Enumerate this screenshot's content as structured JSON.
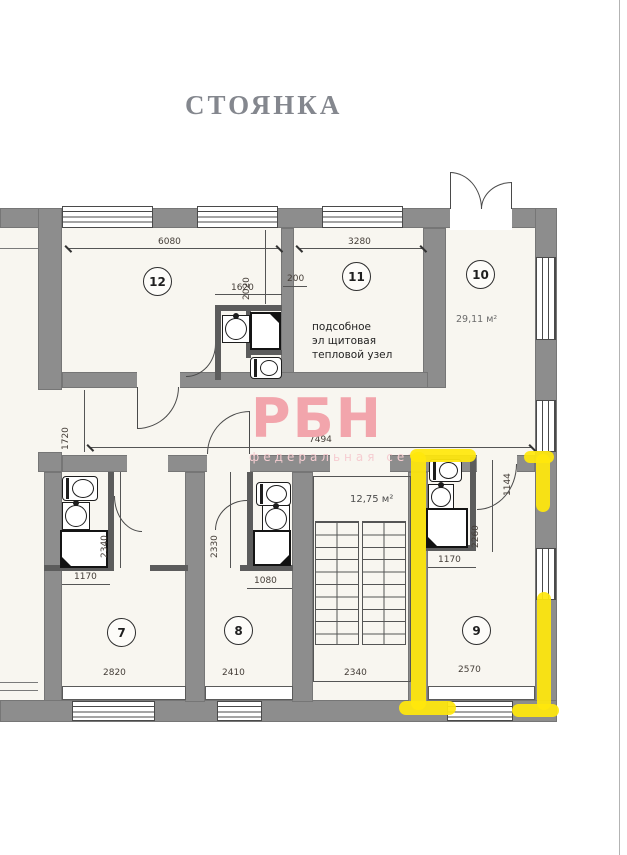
{
  "title": "СТОЯНКА",
  "watermark": {
    "name": "РБН",
    "tagline": "федеральная сеть"
  },
  "rooms": {
    "r7": {
      "number": "7"
    },
    "r8": {
      "number": "8"
    },
    "r9": {
      "number": "9"
    },
    "r10": {
      "number": "10",
      "area": "29,11 м²"
    },
    "r11": {
      "number": "11",
      "label": [
        "подсобное",
        "эл щитовая",
        "тепловой узел"
      ]
    },
    "r12": {
      "number": "12"
    },
    "stairs": {
      "area": "12,75 м²"
    }
  },
  "dims": {
    "r12_width": "6080",
    "r11_width": "3280",
    "bath12_width": "1620",
    "wall_offset": "200",
    "r12_side": "2020",
    "corr_width": "1720",
    "corr_length": "7494",
    "r7_bath_h": "2340",
    "r7_bath_w": "1170",
    "r7_width": "2820",
    "r8_bath_h": "2330",
    "r8_bath_w": "1080",
    "r8_width": "2410",
    "stairs_width": "2340",
    "r9_bath_h": "2260",
    "r9_bath_w": "1170",
    "r9_width": "2570",
    "r9_side": "1144"
  },
  "colors": {
    "highlight": "#ffe70c",
    "wall": "#8d8d8d",
    "watermark": "#f2a5ac"
  }
}
